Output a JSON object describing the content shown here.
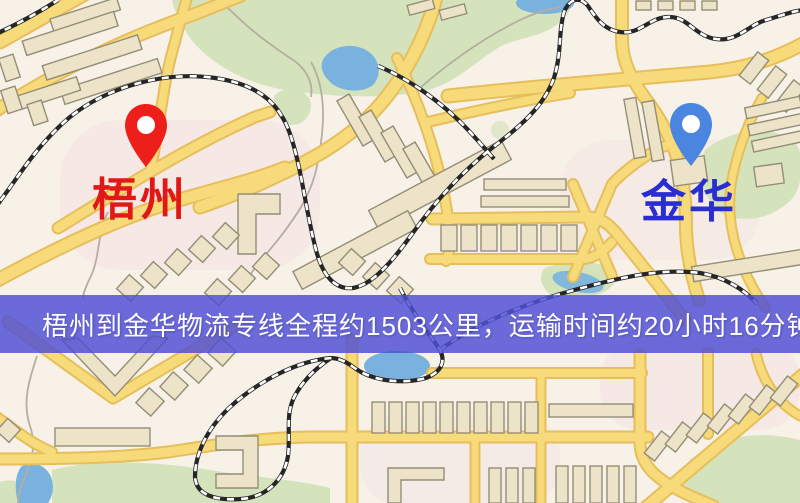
{
  "banner": {
    "text": "梧州到金华物流专线全程约1503公里，运输时间约20小时16分钟.",
    "background_color": "#5050d4",
    "text_color": "#ffffff"
  },
  "markers": {
    "origin": {
      "label": "梧州",
      "pin_color": "#ee1f1b",
      "label_color": "#e21717"
    },
    "destination": {
      "label": "金华",
      "pin_color": "#4a86e0",
      "label_color": "#2a2ed0"
    }
  },
  "map_colors": {
    "background": "#f7f1e8",
    "road_fill": "#f7da79",
    "road_casing": "#e6bf5c",
    "park_green": "#d5e3bd",
    "water_blue": "#79b2de",
    "building_fill": "#ece3c8",
    "building_outline": "#948e76",
    "railway_black": "#262626"
  }
}
